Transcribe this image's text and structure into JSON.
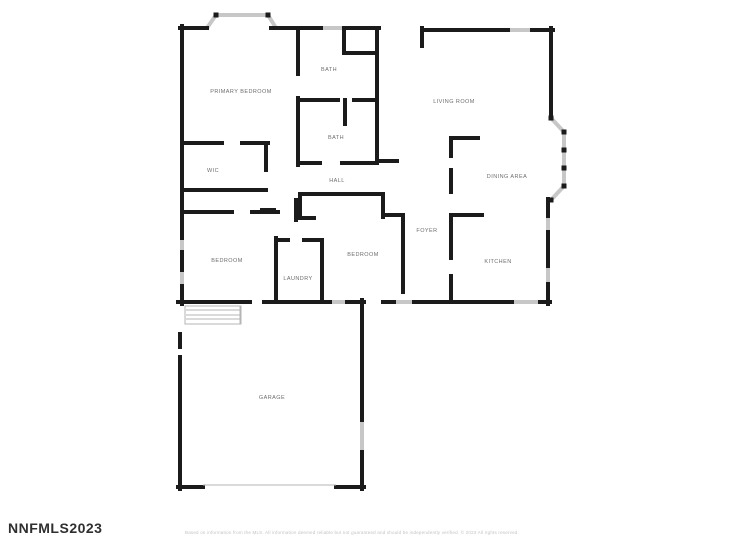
{
  "watermark": {
    "text": "NNFMLS2023"
  },
  "footer": {
    "disclaimer": "Based on information from the MLS. All information deemed reliable but not guaranteed and should be independently verified. © 2023 All rights reserved."
  },
  "colors": {
    "wall": "#1b1b1b",
    "window": "#c7c7c7",
    "thin": "#b5b5b5",
    "label": "#6e6e6e",
    "background": "#ffffff"
  },
  "floorplan": {
    "rooms": [
      {
        "slug": "primary-bedroom",
        "label": "PRIMARY BEDROOM",
        "x": 241,
        "y": 93
      },
      {
        "slug": "bath-1",
        "label": "BATH",
        "x": 329,
        "y": 71
      },
      {
        "slug": "bath-2",
        "label": "BATH",
        "x": 336,
        "y": 139
      },
      {
        "slug": "wic",
        "label": "WIC",
        "x": 213,
        "y": 172
      },
      {
        "slug": "hall",
        "label": "HALL",
        "x": 337,
        "y": 182
      },
      {
        "slug": "bedroom-left",
        "label": "BEDROOM",
        "x": 227,
        "y": 262
      },
      {
        "slug": "laundry",
        "label": "LAUNDRY",
        "x": 298,
        "y": 280
      },
      {
        "slug": "bedroom-middle",
        "label": "BEDROOM",
        "x": 363,
        "y": 256
      },
      {
        "slug": "foyer",
        "label": "FOYER",
        "x": 427,
        "y": 232
      },
      {
        "slug": "living-room",
        "label": "LIVING ROOM",
        "x": 454,
        "y": 103
      },
      {
        "slug": "dining-area",
        "label": "DINING AREA",
        "x": 507,
        "y": 178
      },
      {
        "slug": "kitchen",
        "label": "KITCHEN",
        "x": 498,
        "y": 263
      },
      {
        "slug": "garage",
        "label": "GARAGE",
        "x": 272,
        "y": 399
      }
    ],
    "walls": [
      [
        182,
        26,
        182,
        238
      ],
      [
        182,
        252,
        182,
        270
      ],
      [
        182,
        286,
        182,
        304
      ],
      [
        180,
        28,
        207,
        28
      ],
      [
        271,
        28,
        321,
        28
      ],
      [
        347,
        28,
        379,
        28
      ],
      [
        377,
        28,
        377,
        163
      ],
      [
        377,
        161,
        397,
        161
      ],
      [
        298,
        28,
        298,
        74
      ],
      [
        344,
        28,
        344,
        50
      ],
      [
        344,
        53,
        377,
        53
      ],
      [
        298,
        98,
        298,
        165
      ],
      [
        298,
        100,
        338,
        100
      ],
      [
        354,
        100,
        377,
        100
      ],
      [
        345,
        100,
        345,
        124
      ],
      [
        298,
        163,
        320,
        163
      ],
      [
        342,
        163,
        377,
        163
      ],
      [
        182,
        143,
        222,
        143
      ],
      [
        242,
        143,
        268,
        143
      ],
      [
        266,
        143,
        266,
        170
      ],
      [
        182,
        190,
        266,
        190
      ],
      [
        262,
        210,
        274,
        210
      ],
      [
        296,
        200,
        296,
        220
      ],
      [
        296,
        218,
        314,
        218
      ],
      [
        182,
        212,
        232,
        212
      ],
      [
        252,
        212,
        278,
        212
      ],
      [
        276,
        238,
        276,
        302
      ],
      [
        278,
        240,
        288,
        240
      ],
      [
        304,
        240,
        322,
        240
      ],
      [
        322,
        240,
        322,
        302
      ],
      [
        300,
        194,
        383,
        194
      ],
      [
        300,
        194,
        300,
        218
      ],
      [
        383,
        194,
        383,
        217
      ],
      [
        383,
        215,
        403,
        215
      ],
      [
        403,
        215,
        403,
        292
      ],
      [
        178,
        302,
        250,
        302
      ],
      [
        264,
        302,
        330,
        302
      ],
      [
        347,
        302,
        364,
        302
      ],
      [
        383,
        302,
        394,
        302
      ],
      [
        414,
        302,
        452,
        302
      ],
      [
        452,
        302,
        512,
        302
      ],
      [
        540,
        302,
        550,
        302
      ],
      [
        180,
        334,
        180,
        347
      ],
      [
        180,
        357,
        180,
        489
      ],
      [
        178,
        487,
        203,
        487
      ],
      [
        336,
        487,
        364,
        487
      ],
      [
        362,
        300,
        362,
        420
      ],
      [
        362,
        452,
        362,
        489
      ],
      [
        422,
        30,
        508,
        30
      ],
      [
        532,
        30,
        553,
        30
      ],
      [
        422,
        28,
        422,
        46
      ],
      [
        551,
        28,
        551,
        118
      ],
      [
        548,
        199,
        548,
        216
      ],
      [
        548,
        232,
        548,
        266
      ],
      [
        548,
        284,
        548,
        304
      ],
      [
        451,
        138,
        451,
        156
      ],
      [
        451,
        170,
        451,
        192
      ],
      [
        451,
        138,
        478,
        138
      ],
      [
        451,
        215,
        482,
        215
      ],
      [
        451,
        215,
        451,
        258
      ],
      [
        451,
        276,
        451,
        302
      ]
    ],
    "windows": [
      [
        182,
        238,
        182,
        252
      ],
      [
        182,
        270,
        182,
        286
      ],
      [
        321,
        28,
        347,
        28
      ],
      [
        508,
        30,
        532,
        30
      ],
      [
        362,
        420,
        362,
        452
      ],
      [
        548,
        216,
        548,
        232
      ],
      [
        548,
        266,
        548,
        284
      ],
      [
        512,
        302,
        540,
        302
      ],
      [
        330,
        302,
        347,
        302
      ],
      [
        394,
        302,
        414,
        302
      ],
      [
        207,
        28,
        216,
        15
      ],
      [
        216,
        15,
        268,
        15
      ],
      [
        268,
        15,
        276,
        28
      ],
      [
        551,
        118,
        564,
        132
      ],
      [
        564,
        132,
        564,
        186
      ],
      [
        564,
        186,
        551,
        200
      ]
    ],
    "posts": [
      [
        216,
        15
      ],
      [
        268,
        15
      ],
      [
        551,
        118
      ],
      [
        564,
        132
      ],
      [
        564,
        150
      ],
      [
        564,
        168
      ],
      [
        564,
        186
      ],
      [
        551,
        200
      ]
    ],
    "thin_lines": [
      [
        203,
        485,
        336,
        485
      ],
      [
        186,
        310,
        240,
        310
      ],
      [
        186,
        315,
        240,
        315
      ],
      [
        186,
        319,
        240,
        319
      ],
      [
        240,
        306,
        240,
        324
      ]
    ],
    "steps_box": {
      "x": 185,
      "y": 306,
      "w": 56,
      "h": 18
    }
  }
}
